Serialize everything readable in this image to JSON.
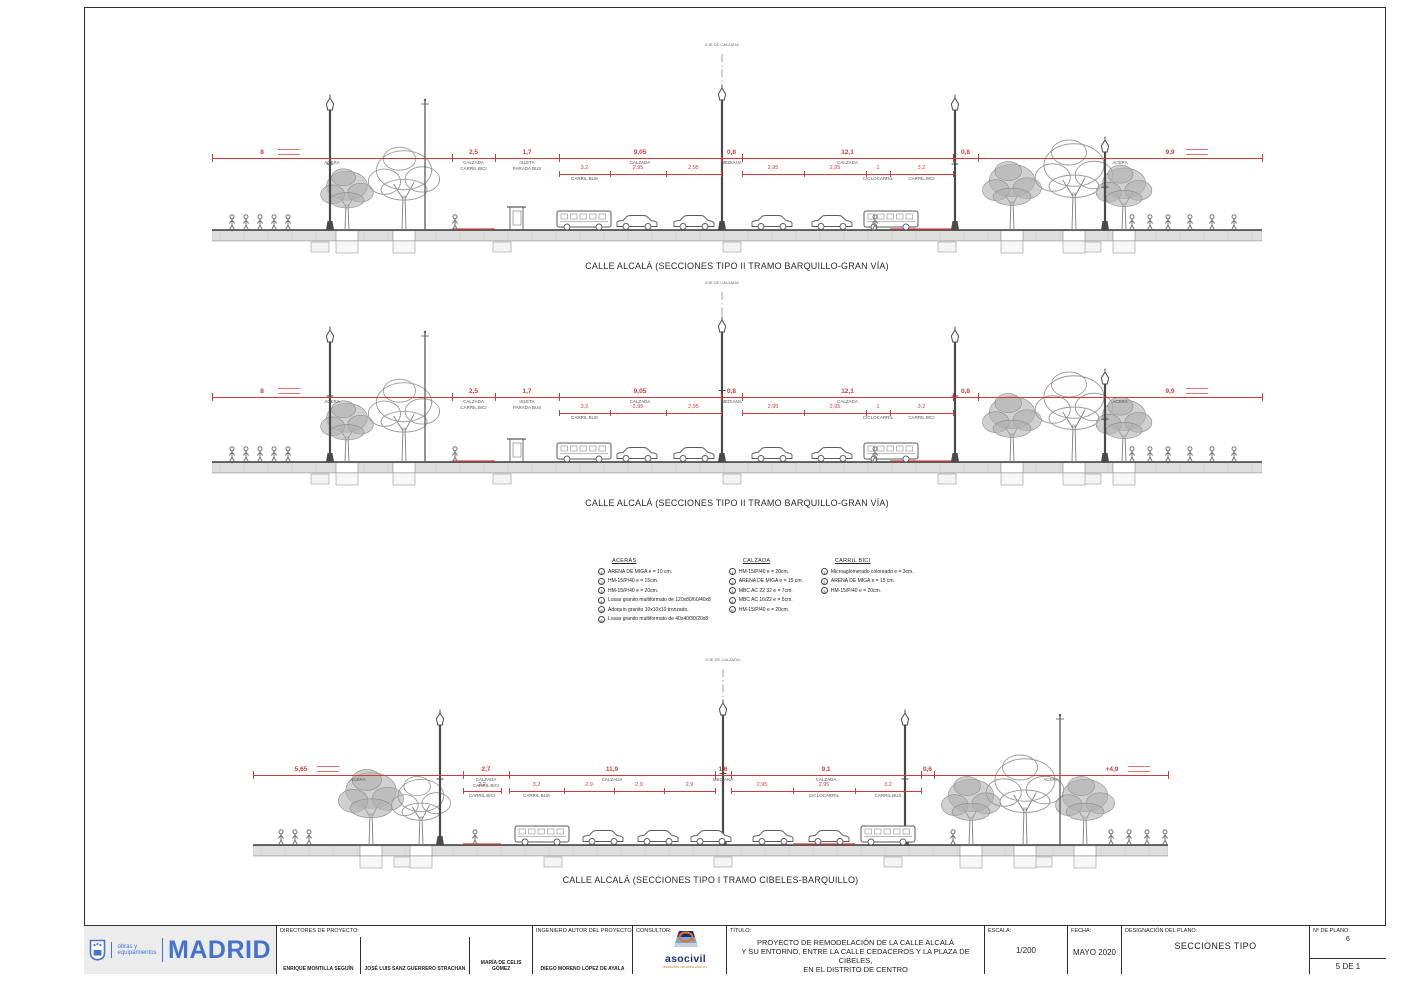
{
  "page": {
    "accent_red": "#cf3b3b",
    "madrid_blue": "#4473cf",
    "asocivil_blue": "#1d2d7c",
    "asocivil_orange": "#e0761f"
  },
  "sections": [
    {
      "caption": "CALLE ALCALÁ (SECCIONES TIPO II TRAMO BARQUILLO-GRAN VÍA)",
      "axis_label": "EJE DE CALZADA",
      "dims": {
        "main": [
          {
            "x1": 0,
            "x2": 240,
            "v": "8",
            "vx": 50,
            "label": "ACERA",
            "note": true
          },
          {
            "x1": 240,
            "x2": 283,
            "v": "2,5",
            "label": "CALZADA",
            "label2": "CARRIL BICI"
          },
          {
            "x1": 283,
            "x2": 347,
            "v": "1,7",
            "label": "ISLETA",
            "label2": "PARADA BUS"
          },
          {
            "x1": 347,
            "x2": 509,
            "v": "9,05",
            "label": "CALZADA"
          },
          {
            "x1": 509,
            "x2": 530,
            "v": "0,8",
            "label": "MEDIANA"
          },
          {
            "x1": 530,
            "x2": 741,
            "v": "12,1",
            "label": "CALZADA"
          },
          {
            "x1": 741,
            "x2": 766,
            "v": "0,8",
            "label": ""
          },
          {
            "x1": 766,
            "x2": 1050,
            "v": "9,9",
            "vx": 958,
            "label": "ACERA",
            "note": true
          }
        ],
        "subs": [
          {
            "x1": 347,
            "x2": 398,
            "v": "3,2",
            "label": "CARRIL BUS"
          },
          {
            "x1": 398,
            "x2": 454,
            "v": "2,95",
            "label": ""
          },
          {
            "x1": 454,
            "x2": 509,
            "v": "2,95",
            "label": ""
          },
          {
            "x1": 530,
            "x2": 592,
            "v": "2,95",
            "label": ""
          },
          {
            "x1": 592,
            "x2": 654,
            "v": "2,95",
            "label": ""
          },
          {
            "x1": 654,
            "x2": 678,
            "v": "1",
            "label": "CICLOCARRIL"
          },
          {
            "x1": 678,
            "x2": 741,
            "v": "3,2",
            "label": "CARRIL BICI"
          }
        ]
      }
    },
    {
      "caption": "CALLE ALCALÁ (SECCIONES TIPO II TRAMO BARQUILLO-GRAN VÍA)",
      "axis_label": "EJE DE CALZADA",
      "dims": {
        "main": [
          {
            "x1": 0,
            "x2": 240,
            "v": "8",
            "vx": 50,
            "label": "ACERA",
            "note": true
          },
          {
            "x1": 240,
            "x2": 283,
            "v": "2,5",
            "label": "CALZADA",
            "label2": "CARRIL BICI"
          },
          {
            "x1": 283,
            "x2": 347,
            "v": "1,7",
            "label": "ISLETA",
            "label2": "PARADA BUS"
          },
          {
            "x1": 347,
            "x2": 509,
            "v": "9,05",
            "label": "CALZADA"
          },
          {
            "x1": 509,
            "x2": 530,
            "v": "0,8",
            "label": "MEDIANA"
          },
          {
            "x1": 530,
            "x2": 741,
            "v": "12,1",
            "label": "CALZADA"
          },
          {
            "x1": 741,
            "x2": 766,
            "v": "0,8",
            "label": ""
          },
          {
            "x1": 766,
            "x2": 1050,
            "v": "9,9",
            "vx": 958,
            "label": "ACERA",
            "note": true
          }
        ],
        "subs": [
          {
            "x1": 347,
            "x2": 398,
            "v": "3,2",
            "label": "CARRIL BUS"
          },
          {
            "x1": 398,
            "x2": 454,
            "v": "2,95",
            "label": ""
          },
          {
            "x1": 454,
            "x2": 509,
            "v": "2,95",
            "label": ""
          },
          {
            "x1": 530,
            "x2": 592,
            "v": "2,95",
            "label": ""
          },
          {
            "x1": 592,
            "x2": 654,
            "v": "2,95",
            "label": ""
          },
          {
            "x1": 654,
            "x2": 678,
            "v": "1",
            "label": "CICLOCARRIL"
          },
          {
            "x1": 678,
            "x2": 741,
            "v": "3,2",
            "label": "CARRIL BICI"
          }
        ]
      }
    },
    {
      "caption": "CALLE ALCALÁ (SECCIONES TIPO I  TRAMO CIBELES-BARQUILLO)",
      "axis_label": "EJE DE CALZADA",
      "dims": {
        "main": [
          {
            "x1": 0,
            "x2": 210,
            "v": "5,65",
            "vx": 48,
            "label": "ACERA",
            "note": true
          },
          {
            "x1": 210,
            "x2": 256,
            "v": "2,7",
            "label": "CALZADA",
            "label2": "CARRIL BICI"
          },
          {
            "x1": 256,
            "x2": 462,
            "v": "11,9",
            "label": "CALZADA"
          },
          {
            "x1": 462,
            "x2": 478,
            "v": "1,6",
            "label": "MEDIANA"
          },
          {
            "x1": 478,
            "x2": 668,
            "v": "9,1",
            "label": "CALZADA"
          },
          {
            "x1": 668,
            "x2": 681,
            "v": "0,6",
            "label": ""
          },
          {
            "x1": 681,
            "x2": 915,
            "v": "+4,9",
            "vx": 859,
            "label": "ACERA",
            "note": true
          }
        ],
        "subs": [
          {
            "x1": 210,
            "x2": 248,
            "v": "2,2",
            "label": "CARRIL BICI"
          },
          {
            "x1": 256,
            "x2": 311,
            "v": "3,2",
            "label": "CARRIL BUS"
          },
          {
            "x1": 311,
            "x2": 361,
            "v": "2,9",
            "label": ""
          },
          {
            "x1": 361,
            "x2": 411,
            "v": "2,9",
            "label": ""
          },
          {
            "x1": 411,
            "x2": 462,
            "v": "2,9",
            "label": ""
          },
          {
            "x1": 478,
            "x2": 540,
            "v": "2,95",
            "label": ""
          },
          {
            "x1": 540,
            "x2": 602,
            "v": "2,95",
            "label": "CICLOCARRIL"
          },
          {
            "x1": 602,
            "x2": 668,
            "v": "3,2",
            "label": "CARRIL BUS"
          }
        ]
      }
    }
  ],
  "legend": {
    "columns": [
      {
        "title": "ACERAS",
        "items": [
          {
            "key": "1",
            "text": "ARENA DE MIGA  e = 10 cm."
          },
          {
            "key": "2",
            "text": "HM-15/P/40  e = 15cm."
          },
          {
            "key": "3",
            "text": "HM-15/P/40  e = 20cm."
          },
          {
            "key": "4",
            "text": "Losas granito multiformato de  120x80/60/40x8"
          },
          {
            "key": "5",
            "text": "Adoquín granito 10x10x10 tronzado."
          },
          {
            "key": "6",
            "text": "Losas granito multiformato de  40x40/30/20x8"
          }
        ]
      },
      {
        "title": "CALZADA",
        "items": [
          {
            "key": "1",
            "text": "HM-15/P/40  e = 20cm."
          },
          {
            "key": "2",
            "text": "ARENA DE MIGA  e = 15 cm."
          },
          {
            "key": "3",
            "text": "MBC AC 22 32  e = 7cm."
          },
          {
            "key": "4",
            "text": "MBC AC 16/22 e = 5cm."
          },
          {
            "key": "5",
            "text": "HM-15/P/40  e = 20cm."
          }
        ]
      },
      {
        "title": "CARRIL BICI",
        "items": [
          {
            "key": "1",
            "text": "Microaglomerado coloreado  e = 3cm."
          },
          {
            "key": "2",
            "text": "ARENA DE MIGA  e = 15 cm."
          },
          {
            "key": "3",
            "text": "HM-15/P/40  e = 20cm."
          }
        ]
      }
    ]
  },
  "titleblock": {
    "logo": {
      "line1": "obras y",
      "line2": "equipamientos",
      "city": "MADRID"
    },
    "directors_label": "DIRECTORES DE PROYECTO:",
    "directors": [
      "ENRIQUE MONTILLA SEGUÍN",
      "JOSÉ LUIS SANZ GUERRERO STRACHAN",
      "MARÍA DE CELIS GÓMEZ"
    ],
    "engineer_label": "INGENIERO AUTOR DEL PROYECTO:",
    "engineer": "DIEGO MORENO LÓPEZ DE AYALA",
    "consultant_label": "CONSULTOR:",
    "consultant_name": "asocivil",
    "consultant_sub": "asesores de obra civil s.l.",
    "title_label": "TÍTULO:",
    "title_line1": "PROYECTO DE REMODELACIÓN DE LA CALLE ALCALÁ",
    "title_line2": "Y SU ENTORNO, ENTRE LA CALLE CEDACEROS Y LA PLAZA DE CIBELES,",
    "title_line3": "EN EL DISTRITO DE CENTRO",
    "scale_label": "ESCALA:",
    "scale": "1/200",
    "date_label": "FECHA:",
    "date": "MAYO 2020",
    "designation_label": "DESIGNACIÓN DEL PLANO:",
    "designation": "SECCIONES TIPO",
    "number_label": "Nº DE PLANO:",
    "number": "6",
    "page": "5 DE 1"
  }
}
